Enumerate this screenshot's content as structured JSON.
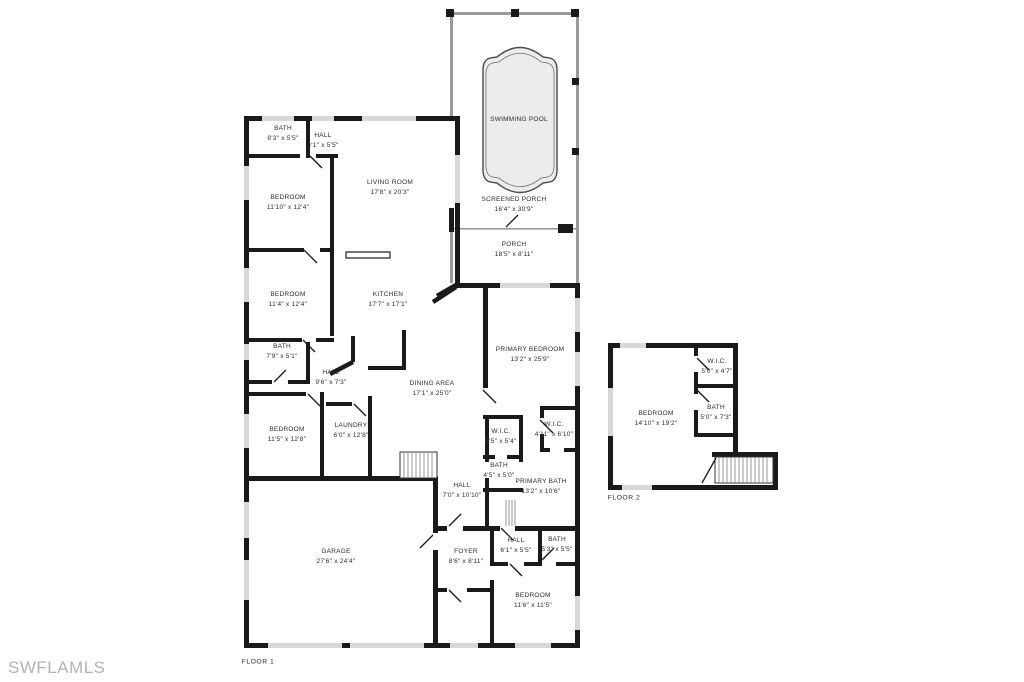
{
  "colors": {
    "wall": "#1a1a1a",
    "window": "#d8d8d8",
    "screen": "#9a9a9a",
    "pool": "#ececec",
    "watermark": "#b3b3b3"
  },
  "labels": {
    "floor1": "FLOOR 1",
    "floor2": "FLOOR 2",
    "watermark": "SWFLAMLS"
  },
  "floor1": {
    "rooms": [
      {
        "name": "BATH",
        "dims": "8'3\" x 5'5\""
      },
      {
        "name": "HALL",
        "dims": "4'1\" x 5'5\""
      },
      {
        "name": "BEDROOM",
        "dims": "11'10\" x 12'4\""
      },
      {
        "name": "LIVING ROOM",
        "dims": "17'8\" x 20'3\""
      },
      {
        "name": "BEDROOM",
        "dims": "11'4\" x 12'4\""
      },
      {
        "name": "BATH",
        "dims": "7'9\" x 5'1\""
      },
      {
        "name": "HALL",
        "dims": "9'6\" x 7'3\""
      },
      {
        "name": "KITCHEN",
        "dims": "17'7\" x 17'1\""
      },
      {
        "name": "DINING AREA",
        "dims": "17'1\" x 25'0\""
      },
      {
        "name": "BEDROOM",
        "dims": "11'5\" x 12'8\""
      },
      {
        "name": "LAUNDRY",
        "dims": "6'0\" x 12'8\""
      },
      {
        "name": "PRIMARY BEDROOM",
        "dims": "13'2\" x 25'9\""
      },
      {
        "name": "W.I.C.",
        "dims": "4'5\" x 5'4\""
      },
      {
        "name": "W.I.C.",
        "dims": "4'11\" x 6'10\""
      },
      {
        "name": "BATH",
        "dims": "4'5\" x 5'0\""
      },
      {
        "name": "PRIMARY BATH",
        "dims": "13'2\" x 10'6\""
      },
      {
        "name": "HALL",
        "dims": "7'0\" x 10'10\""
      },
      {
        "name": "GARAGE",
        "dims": "27'6\" x 24'4\""
      },
      {
        "name": "FOYER",
        "dims": "8'6\" x 8'11\""
      },
      {
        "name": "HALL",
        "dims": "6'1\" x 5'5\""
      },
      {
        "name": "BATH",
        "dims": "5'3\" x 5'5\""
      },
      {
        "name": "BEDROOM",
        "dims": "11'6\" x 11'5\""
      },
      {
        "name": "SCREENED PORCH",
        "dims": "16'4\" x 30'9\""
      },
      {
        "name": "SWIMMING POOL",
        "dims": ""
      },
      {
        "name": "PORCH",
        "dims": "18'5\" x 8'11\""
      }
    ]
  },
  "floor2": {
    "rooms": [
      {
        "name": "BEDROOM",
        "dims": "14'10\" x 19'2\""
      },
      {
        "name": "W.I.C.",
        "dims": "5'0\" x 4'7\""
      },
      {
        "name": "BATH",
        "dims": "5'0\" x 7'3\""
      }
    ]
  }
}
